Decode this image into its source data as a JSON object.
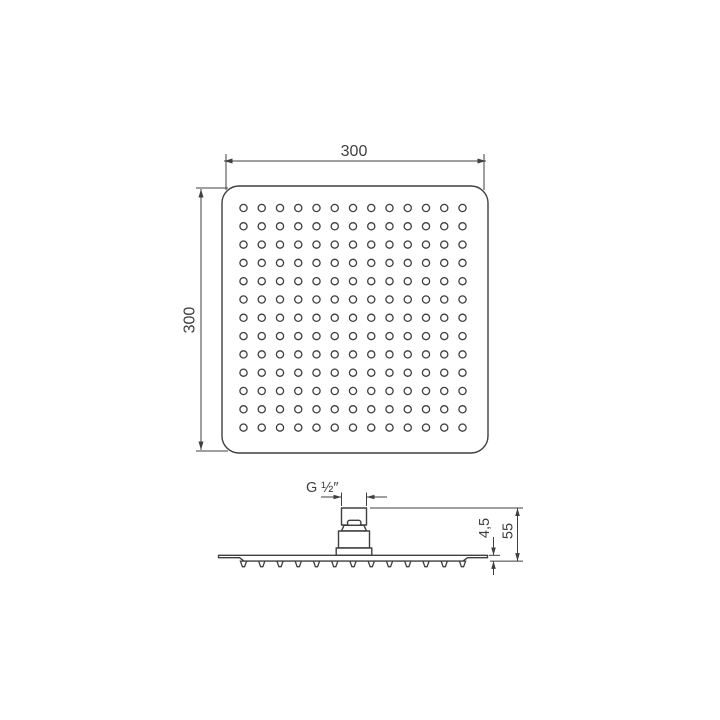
{
  "drawing": {
    "kind": "shower-head-technical-drawing",
    "colors": {
      "line": "#3f3f3f",
      "background": "#ffffff"
    },
    "top_view": {
      "width_label": "300",
      "height_label": "300",
      "hole_rows": 13,
      "hole_cols": 13
    },
    "side_view": {
      "thread_label": "G ½″",
      "plate_thickness_label": "4,5",
      "total_height_label": "55",
      "nozzle_count": 13
    }
  }
}
